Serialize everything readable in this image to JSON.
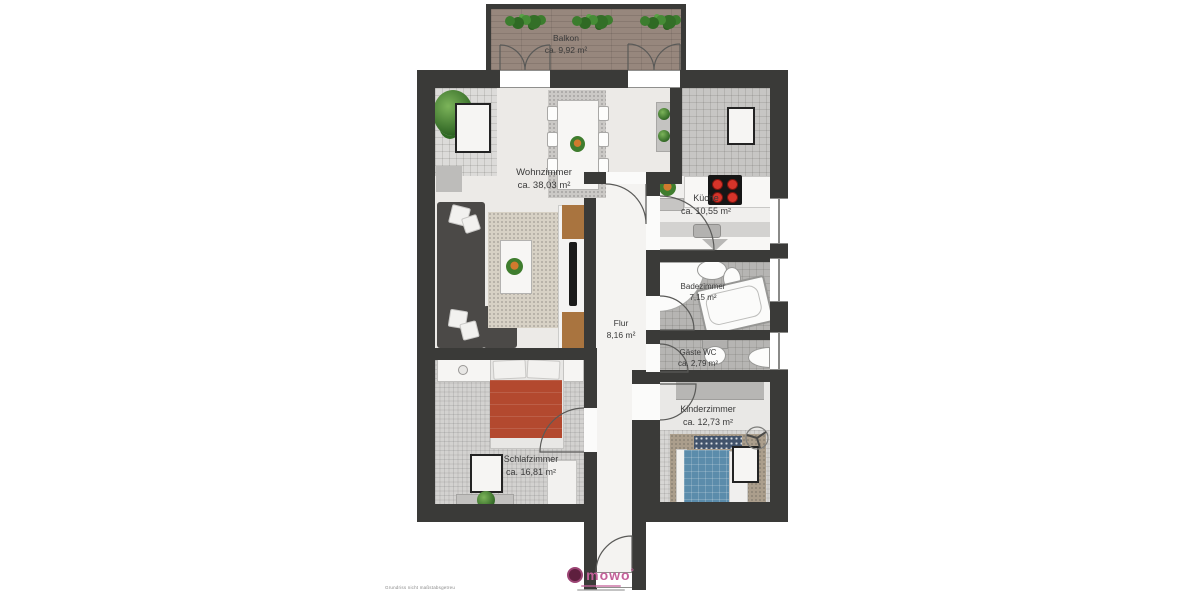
{
  "plan": {
    "rooms": [
      {
        "id": "balkon",
        "name": "Balkon",
        "area": "ca. 9,92 m²"
      },
      {
        "id": "wohnzimmer",
        "name": "Wohnzimmer",
        "area": "ca. 38,03 m²"
      },
      {
        "id": "kueche",
        "name": "Küche",
        "area": "ca. 10,55 m²"
      },
      {
        "id": "badezimmer",
        "name": "Badezimmer",
        "area": "7,15 m²"
      },
      {
        "id": "flur",
        "name": "Flur",
        "area": "8,16 m²"
      },
      {
        "id": "gaeste_wc",
        "name": "Gäste WC",
        "area": "ca. 2,79 m²"
      },
      {
        "id": "kinderzimmer",
        "name": "Kinderzimmer",
        "area": "ca. 12,73 m²"
      },
      {
        "id": "schlafzimmer",
        "name": "Schlafzimmer",
        "area": "ca. 16,81 m²"
      }
    ],
    "logo": {
      "text": "mowo",
      "sup": "°"
    },
    "footnote": "Grundriss nicht maßstabsgetreu",
    "colors": {
      "wall": "#3a3a38",
      "logo_accent": "#c4619a",
      "bed_red": "#b3492f",
      "bed_blue": "#5b8cab",
      "stove_burner": "#d5342a",
      "plant_green": "#3f7d2e",
      "balcony_wood": "#97877d"
    }
  }
}
